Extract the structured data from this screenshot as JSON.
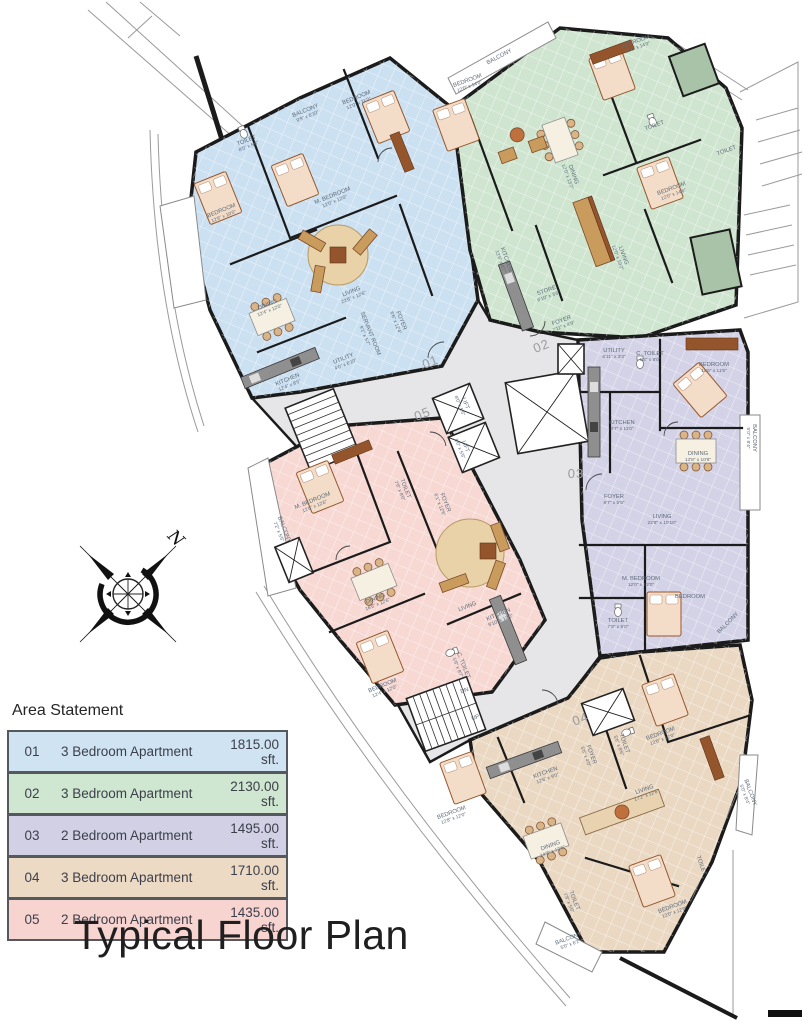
{
  "title": "Typical Floor Plan",
  "compass": {
    "north_label": "N"
  },
  "area_statement": {
    "heading": "Area Statement",
    "rows": [
      {
        "no": "01",
        "type": "3 Bedroom Apartment",
        "area": "1815.00 sft.",
        "color": "#cfe3f2"
      },
      {
        "no": "02",
        "type": "3 Bedroom Apartment",
        "area": "2130.00 sft.",
        "color": "#cfe6d0"
      },
      {
        "no": "03",
        "type": "2 Bedroom Apartment",
        "area": "1495.00 sft.",
        "color": "#d1d0e5"
      },
      {
        "no": "04",
        "type": "3 Bedroom Apartment",
        "area": "1710.00 sft.",
        "color": "#ecdac5"
      },
      {
        "no": "05",
        "type": "2 Bedroom Apartment",
        "area": "1435.00 sft.",
        "color": "#f8d4d1"
      }
    ]
  },
  "plan": {
    "colors": {
      "apt01": "#cbe0f1",
      "apt02": "#cfe5d0",
      "apt03": "#d3d2e7",
      "apt04": "#ead8c2",
      "apt05": "#f7d8d3",
      "corridor": "#e6e6e8",
      "wall": "#1b1b1b"
    },
    "units": [
      {
        "number": "01"
      },
      {
        "number": "02"
      },
      {
        "number": "03"
      },
      {
        "number": "04"
      },
      {
        "number": "05"
      }
    ],
    "rooms": [
      {
        "name": "BEDROOM",
        "dims": "12'6\" x 10'0\""
      },
      {
        "name": "BEDROOM",
        "dims": "12'0\" x 11'0\""
      },
      {
        "name": "M. BEDROOM",
        "dims": "12'0\" x 12'0\""
      },
      {
        "name": "TOILET",
        "dims": "8'0\" x 5'6\""
      },
      {
        "name": "BALCONY",
        "dims": "9'9\" x 6'10\""
      },
      {
        "name": "DINING",
        "dims": "12'4\" x 12'0\""
      },
      {
        "name": "KITCHEN",
        "dims": "12'4\" x 8'5\""
      },
      {
        "name": "UTILITY",
        "dims": "4'0\" x 6'10\""
      },
      {
        "name": "SERVANT ROOM",
        "dims": "9'1\" x 5'7\""
      },
      {
        "name": "FOYER",
        "dims": "6'6\" x 12'4\""
      },
      {
        "name": "LIVING",
        "dims": "22'6\" x 12'6\""
      },
      {
        "name": "BEDROOM",
        "dims": "12'0\" x 14'0\""
      },
      {
        "name": "BEDROOM",
        "dims": "12'0\" x 14'0\""
      },
      {
        "name": "BEDROOM",
        "dims": "12'0\" x 14'6\""
      },
      {
        "name": "DINING",
        "dims": "12'0\" x 13'2\""
      },
      {
        "name": "LIVING",
        "dims": "12'0\" x 19'2\""
      },
      {
        "name": "KITCHEN",
        "dims": "12'6\" x 8'7\""
      },
      {
        "name": "TOILET",
        "dims": ""
      },
      {
        "name": "TOILET",
        "dims": ""
      },
      {
        "name": "BALCONY",
        "dims": ""
      },
      {
        "name": "UTILITY",
        "dims": "6'11\" x 3'3\""
      },
      {
        "name": "C. TOILET",
        "dims": "5'3\" x 8'0\""
      },
      {
        "name": "BEDROOM",
        "dims": "11'6\" x 11'5\""
      },
      {
        "name": "KITCHEN",
        "dims": "8'7\" x 11'0\""
      },
      {
        "name": "BALCONY",
        "dims": "5'0\" x 8'4\""
      },
      {
        "name": "DINING",
        "dims": "13'8\" x 10'8\""
      },
      {
        "name": "FOYER",
        "dims": "8'7\" x 5'5\""
      },
      {
        "name": "LIVING",
        "dims": "22'8\" x 10'10\""
      },
      {
        "name": "M. BEDROOM",
        "dims": "12'0\" x 12'0\""
      },
      {
        "name": "TOILET",
        "dims": "7'8\" x 5'0\""
      },
      {
        "name": "BEDROOM",
        "dims": ""
      },
      {
        "name": "BALCONY",
        "dims": ""
      },
      {
        "name": "M. BEDROOM",
        "dims": "12'6\" x 12'6\""
      },
      {
        "name": "TOILET",
        "dims": "7'6\" x 8'0\""
      },
      {
        "name": "FOYER",
        "dims": "6'1\" x 12'6\""
      },
      {
        "name": "DINING",
        "dims": "16'6\" x 12'6\""
      },
      {
        "name": "LIVING",
        "dims": ""
      },
      {
        "name": "KITCHEN",
        "dims": "9'10\" x 12'0\""
      },
      {
        "name": "C. TOILET",
        "dims": "5'6\" x 8'7\""
      },
      {
        "name": "BEDROOM",
        "dims": "12'4\" x 12'0\""
      },
      {
        "name": "BALCONY",
        "dims": "7'2\" x 5'6\""
      },
      {
        "name": "KITCHEN",
        "dims": "12'6\" x 9'0\""
      },
      {
        "name": "FOYER",
        "dims": "5'6\" x 4'0\""
      },
      {
        "name": "TOILET",
        "dims": "5'6\" x 8'6\""
      },
      {
        "name": "BEDROOM",
        "dims": "12'6\" x 12'0\""
      },
      {
        "name": "LIVING",
        "dims": "17'2\" x 12'6\""
      },
      {
        "name": "DINING",
        "dims": "14'2\" x 12'6\""
      },
      {
        "name": "BEDROOM",
        "dims": "12'8\" x 12'0\""
      },
      {
        "name": "BEDROOM",
        "dims": "12'0\" x 12'0\""
      },
      {
        "name": "TOILET",
        "dims": "7'8\" x 5'0\""
      },
      {
        "name": "TOILET",
        "dims": ""
      },
      {
        "name": "BALCONY",
        "dims": "5'0\" x 8'4\""
      },
      {
        "name": "BALCONY",
        "dims": "5'0\" x 6'2\""
      },
      {
        "name": "LIFT",
        "dims": "8'0\" x 5'6\""
      },
      {
        "name": "LIFT",
        "dims": "8'0\" x 5'6\""
      },
      {
        "name": "UP",
        "dims": ""
      },
      {
        "name": "DN",
        "dims": ""
      },
      {
        "name": "STORE",
        "dims": "6'10\" x 3'6\""
      },
      {
        "name": "FOYER",
        "dims": "7'11\" x 4'9\""
      }
    ]
  }
}
